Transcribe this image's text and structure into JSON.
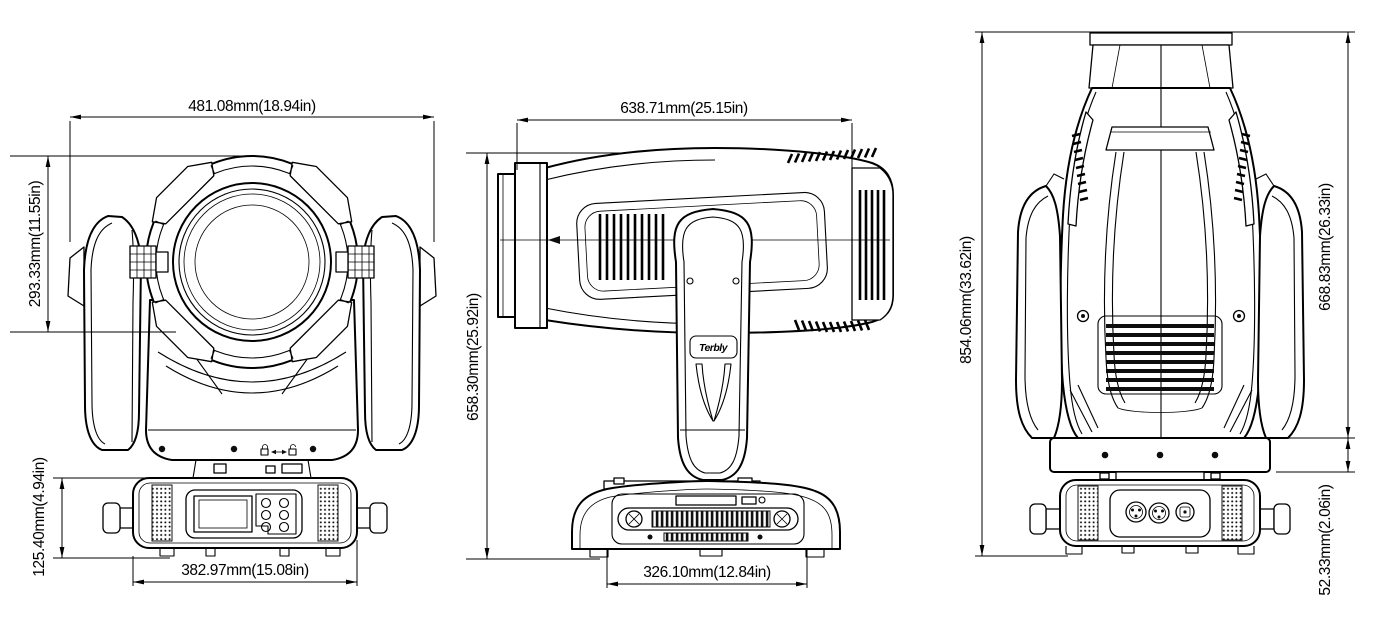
{
  "page": {
    "background": "#ffffff",
    "ink": "#000000",
    "description": "Three-view dimensional line drawing of a moving head stage light fixture"
  },
  "drawing": {
    "views": {
      "front": {
        "name": "front-view",
        "dimensions": {
          "overall_width": "481.08mm(18.94in)",
          "head_height": "293.33mm(11.55in)",
          "base_height": "125.40mm(4.94in)",
          "base_width": "382.97mm(15.08in)"
        }
      },
      "side": {
        "name": "side-view",
        "logo": "Terbly",
        "dimensions": {
          "head_length": "638.71mm(25.15in)",
          "overall_height": "658.30mm(25.92in)",
          "base_width": "326.10mm(12.84in)"
        }
      },
      "back": {
        "name": "back-view",
        "dimensions": {
          "max_height": "854.06mm(33.62in)",
          "body_height": "668.83mm(26.33in)",
          "yoke_base_height": "52.33mm(2.06in)"
        }
      }
    }
  }
}
